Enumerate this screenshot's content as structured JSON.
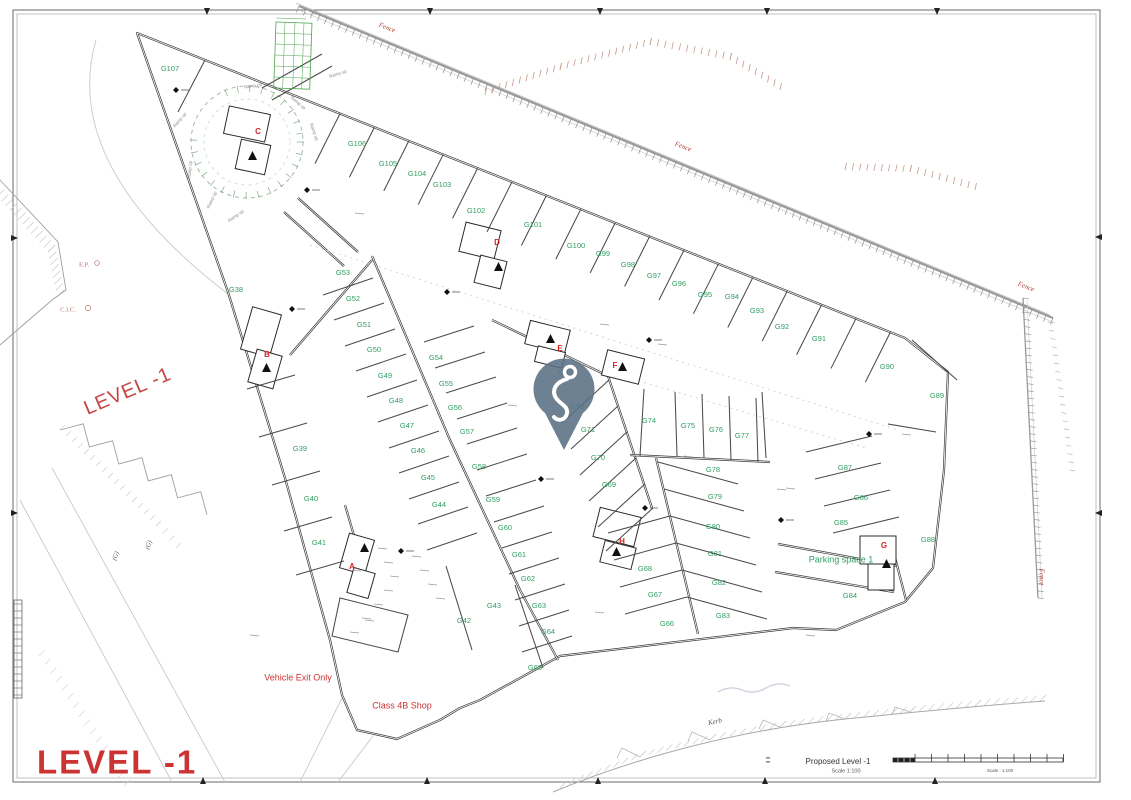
{
  "level_labels": {
    "corner": "LEVEL -1",
    "rotated": "LEVEL -1"
  },
  "title_block": {
    "title": "Proposed Level -1",
    "scale": "Scale 1:100",
    "scalebar_caption": "Scale : 1:100"
  },
  "colors": {
    "green": "#2f9e62",
    "red": "#cc3333",
    "core_red": "#d42222",
    "wall": "#3a3a3a",
    "pin": "#5a7083",
    "fence_red": "#b5443a"
  },
  "parking_spaces": [
    {
      "id": "G38",
      "x": 236,
      "y": 290
    },
    {
      "id": "G39",
      "x": 300,
      "y": 449
    },
    {
      "id": "G40",
      "x": 311,
      "y": 499
    },
    {
      "id": "G41",
      "x": 319,
      "y": 543
    },
    {
      "id": "G42",
      "x": 464,
      "y": 621
    },
    {
      "id": "G43",
      "x": 494,
      "y": 606
    },
    {
      "id": "G44",
      "x": 439,
      "y": 505
    },
    {
      "id": "G45",
      "x": 428,
      "y": 478
    },
    {
      "id": "G46",
      "x": 418,
      "y": 451
    },
    {
      "id": "G47",
      "x": 407,
      "y": 426
    },
    {
      "id": "G48",
      "x": 396,
      "y": 401
    },
    {
      "id": "G49",
      "x": 385,
      "y": 376
    },
    {
      "id": "G50",
      "x": 374,
      "y": 350
    },
    {
      "id": "G51",
      "x": 364,
      "y": 325
    },
    {
      "id": "G52",
      "x": 353,
      "y": 299
    },
    {
      "id": "G53",
      "x": 343,
      "y": 273
    },
    {
      "id": "G54",
      "x": 436,
      "y": 358
    },
    {
      "id": "G55",
      "x": 446,
      "y": 384
    },
    {
      "id": "G56",
      "x": 455,
      "y": 408
    },
    {
      "id": "G57",
      "x": 467,
      "y": 432
    },
    {
      "id": "G58",
      "x": 479,
      "y": 467
    },
    {
      "id": "G59",
      "x": 493,
      "y": 500
    },
    {
      "id": "G60",
      "x": 505,
      "y": 528
    },
    {
      "id": "G61",
      "x": 519,
      "y": 555
    },
    {
      "id": "G62",
      "x": 528,
      "y": 579
    },
    {
      "id": "G63",
      "x": 539,
      "y": 606
    },
    {
      "id": "G64",
      "x": 548,
      "y": 632
    },
    {
      "id": "G65",
      "x": 535,
      "y": 668
    },
    {
      "id": "G66",
      "x": 667,
      "y": 624
    },
    {
      "id": "G67",
      "x": 655,
      "y": 595
    },
    {
      "id": "G68",
      "x": 645,
      "y": 569
    },
    {
      "id": "G69",
      "x": 609,
      "y": 485
    },
    {
      "id": "G70",
      "x": 598,
      "y": 458
    },
    {
      "id": "G71",
      "x": 588,
      "y": 430
    },
    {
      "id": "G72",
      "x": 566,
      "y": 373
    },
    {
      "id": "G73",
      "x": 577,
      "y": 407
    },
    {
      "id": "G74",
      "x": 649,
      "y": 421
    },
    {
      "id": "G75",
      "x": 688,
      "y": 426
    },
    {
      "id": "G76",
      "x": 716,
      "y": 430
    },
    {
      "id": "G77",
      "x": 742,
      "y": 436
    },
    {
      "id": "G78",
      "x": 713,
      "y": 470
    },
    {
      "id": "G79",
      "x": 715,
      "y": 497
    },
    {
      "id": "G80",
      "x": 713,
      "y": 527
    },
    {
      "id": "G81",
      "x": 715,
      "y": 554
    },
    {
      "id": "G82",
      "x": 719,
      "y": 583
    },
    {
      "id": "G83",
      "x": 723,
      "y": 616
    },
    {
      "id": "G84",
      "x": 850,
      "y": 596
    },
    {
      "id": "G85",
      "x": 841,
      "y": 523
    },
    {
      "id": "G86",
      "x": 861,
      "y": 498
    },
    {
      "id": "G87",
      "x": 845,
      "y": 468
    },
    {
      "id": "G88",
      "x": 928,
      "y": 540
    },
    {
      "id": "G89",
      "x": 937,
      "y": 396
    },
    {
      "id": "G90",
      "x": 887,
      "y": 367
    },
    {
      "id": "G91",
      "x": 819,
      "y": 339
    },
    {
      "id": "G92",
      "x": 782,
      "y": 327
    },
    {
      "id": "G93",
      "x": 757,
      "y": 311
    },
    {
      "id": "G94",
      "x": 732,
      "y": 297
    },
    {
      "id": "G95",
      "x": 705,
      "y": 295
    },
    {
      "id": "G96",
      "x": 679,
      "y": 284
    },
    {
      "id": "G97",
      "x": 654,
      "y": 276
    },
    {
      "id": "G98",
      "x": 628,
      "y": 265
    },
    {
      "id": "G99",
      "x": 603,
      "y": 254
    },
    {
      "id": "G100",
      "x": 576,
      "y": 246
    },
    {
      "id": "G101",
      "x": 533,
      "y": 225
    },
    {
      "id": "G102",
      "x": 476,
      "y": 211
    },
    {
      "id": "G103",
      "x": 442,
      "y": 185
    },
    {
      "id": "G104",
      "x": 417,
      "y": 174
    },
    {
      "id": "G105",
      "x": 388,
      "y": 164
    },
    {
      "id": "G106",
      "x": 357,
      "y": 144
    },
    {
      "id": "G107",
      "x": 170,
      "y": 69
    }
  ],
  "special_labels": [
    {
      "text": "Parking space 1",
      "x": 841,
      "y": 560
    }
  ],
  "stair_cores": [
    {
      "id": "A",
      "x": 352,
      "y": 567
    },
    {
      "id": "B",
      "x": 267,
      "y": 355
    },
    {
      "id": "C",
      "x": 258,
      "y": 132
    },
    {
      "id": "D",
      "x": 497,
      "y": 243
    },
    {
      "id": "E",
      "x": 560,
      "y": 349
    },
    {
      "id": "F",
      "x": 615,
      "y": 366
    },
    {
      "id": "G",
      "x": 884,
      "y": 546
    },
    {
      "id": "H",
      "x": 622,
      "y": 542
    }
  ],
  "red_annotations": [
    {
      "text": "Vehicle Exit Only",
      "x": 298,
      "y": 678,
      "size": 9,
      "rot": 0
    },
    {
      "text": "Class 4B Shop",
      "x": 402,
      "y": 706,
      "size": 9,
      "rot": 0
    }
  ],
  "site_labels": [
    {
      "text": "E.P.",
      "x": 84,
      "y": 265,
      "size": 6.5
    },
    {
      "text": "C.I.C.",
      "x": 68,
      "y": 310,
      "size": 6.5
    }
  ],
  "fence_labels": [
    {
      "text": "Fence",
      "x": 387,
      "y": 28,
      "rot": 21
    },
    {
      "text": "Fence",
      "x": 683,
      "y": 147,
      "rot": 21
    },
    {
      "text": "Fence",
      "x": 1026,
      "y": 287,
      "rot": 21
    },
    {
      "text": "Fence",
      "x": 1041,
      "y": 577,
      "rot": 90
    }
  ],
  "gray_labels": [
    {
      "text": "Kerb",
      "x": 715,
      "y": 722,
      "size": 7,
      "rot": -12
    },
    {
      "text": "(G)",
      "x": 116,
      "y": 556,
      "size": 6.5,
      "rot": -72
    },
    {
      "text": "(G)",
      "x": 149,
      "y": 545,
      "size": 6.5,
      "rot": -72
    }
  ],
  "ramp_labels": [
    {
      "text": "Ramp up",
      "x": 253,
      "y": 86,
      "rot": -10
    },
    {
      "text": "Ramp up",
      "x": 298,
      "y": 103,
      "rot": 40
    },
    {
      "text": "Ramp up",
      "x": 314,
      "y": 132,
      "rot": 70
    },
    {
      "text": "Ramp up",
      "x": 180,
      "y": 120,
      "rot": -50
    },
    {
      "text": "Ramp up",
      "x": 190,
      "y": 170,
      "rot": -85
    },
    {
      "text": "Ramp up",
      "x": 212,
      "y": 200,
      "rot": -65
    },
    {
      "text": "Ramp up",
      "x": 236,
      "y": 216,
      "rot": -35
    },
    {
      "text": "Ramp up",
      "x": 338,
      "y": 74,
      "rot": -18
    }
  ]
}
